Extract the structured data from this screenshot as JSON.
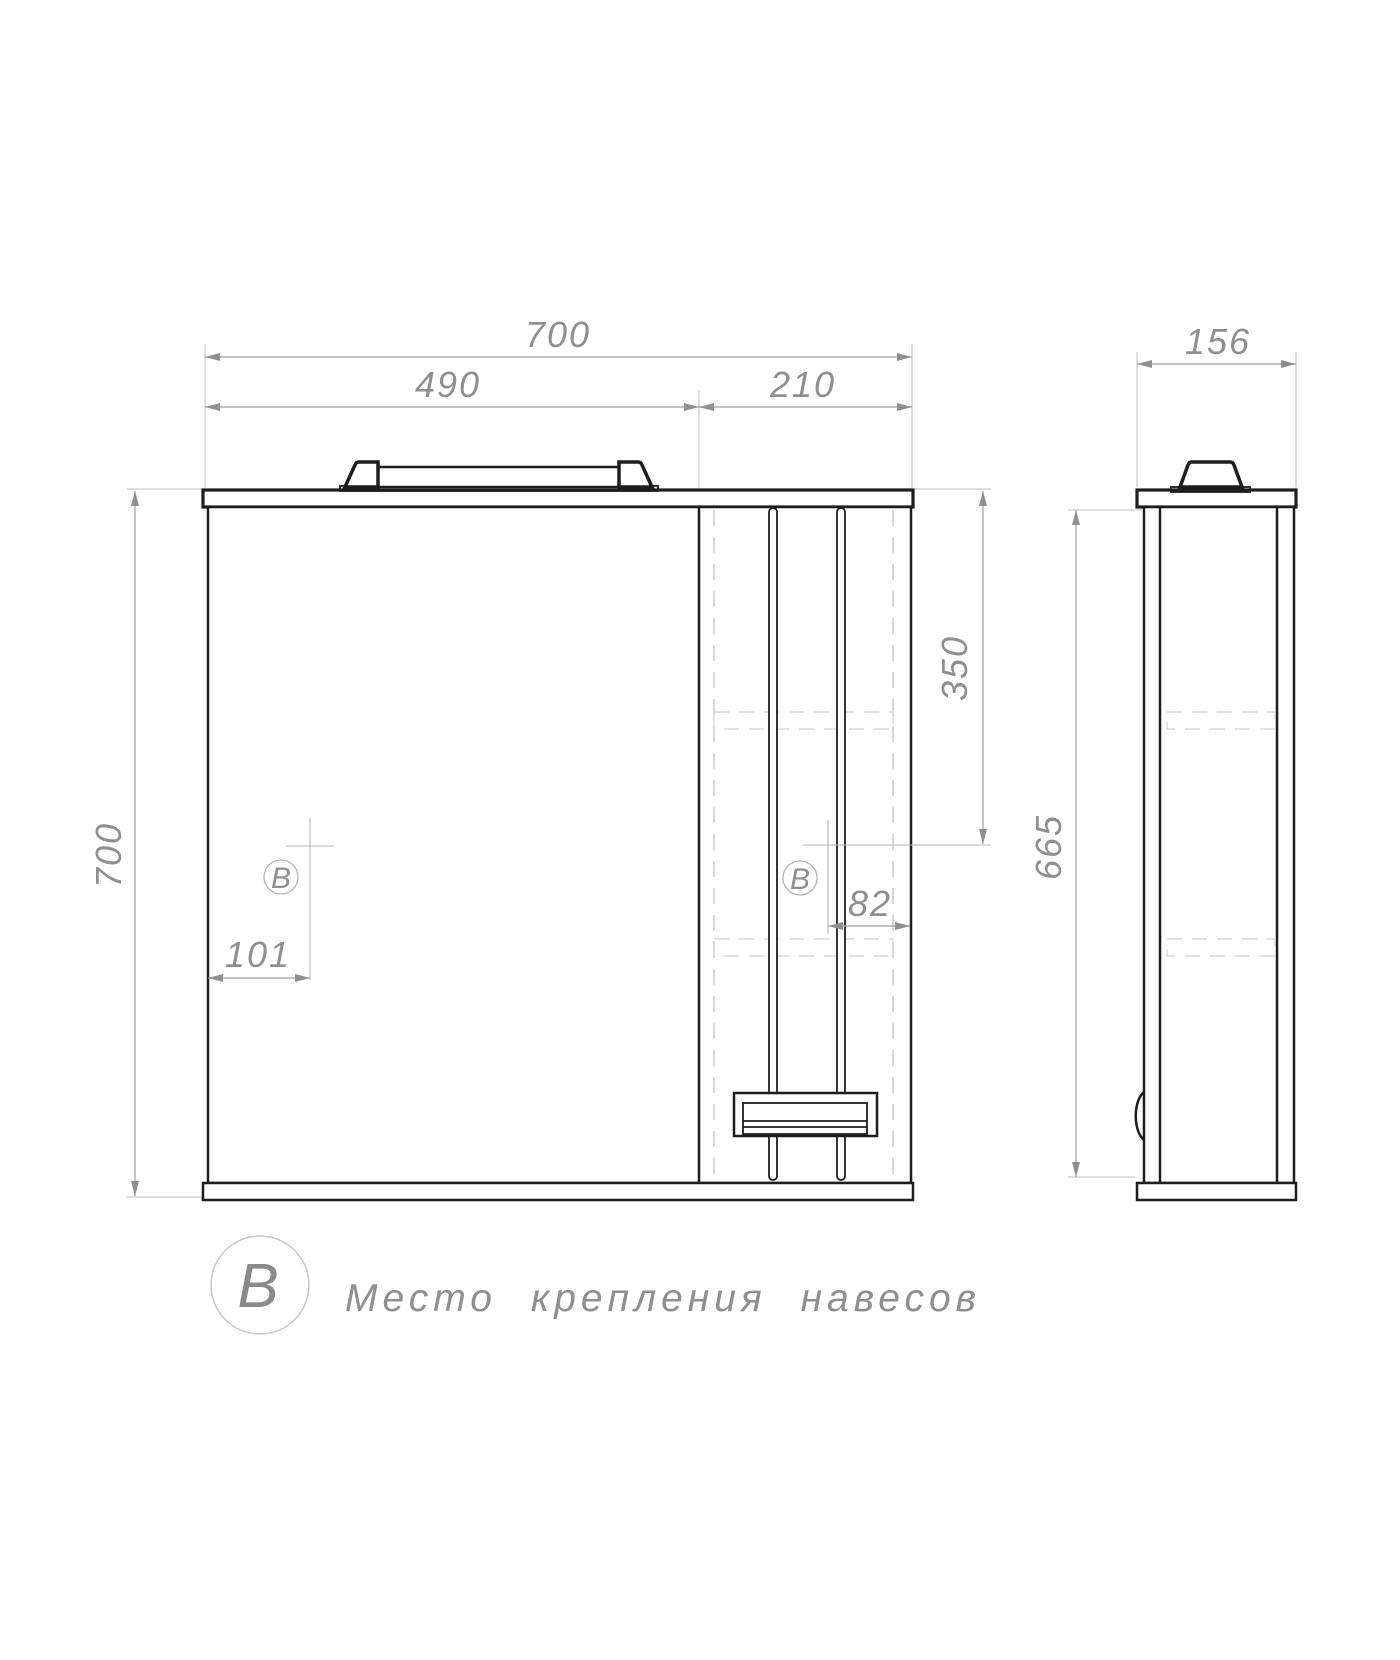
{
  "views": {
    "front": {
      "dims": {
        "total_width": "700",
        "mirror_width": "490",
        "cabinet_width": "210",
        "total_height": "700",
        "hinge_from_top": "350",
        "hinge_from_right_edge": "82",
        "hinge_from_left_edge": "101"
      },
      "marker_symbol": "B"
    },
    "side": {
      "dims": {
        "depth": "156",
        "carcass_height": "665"
      }
    }
  },
  "legend": {
    "symbol": "B",
    "label": "Место крепления навесов"
  }
}
